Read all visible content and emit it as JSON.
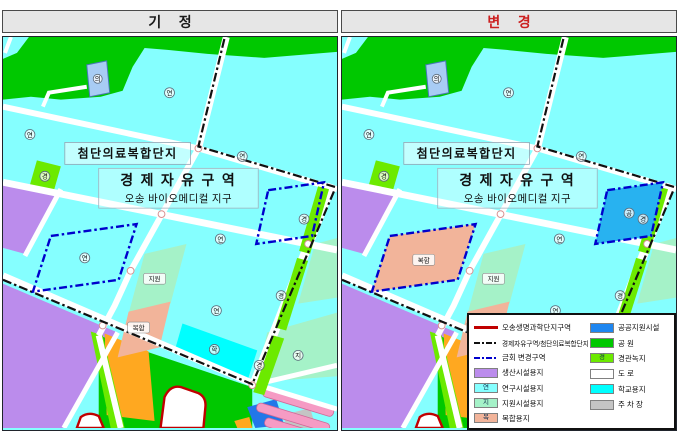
{
  "panels": [
    {
      "id": "before",
      "title": "기 정",
      "title_color": "#1a1a1a",
      "show_legend": false,
      "changes": {
        "zone1_fill": "",
        "zone2_fill": "",
        "zone1_marker": "research_glyph",
        "zone2_marker": ""
      }
    },
    {
      "id": "after",
      "title": "변 경",
      "title_color": "#cc2020",
      "show_legend": true,
      "changes": {
        "zone1_fill": "#f2b49a",
        "zone2_fill": "#28b2f0",
        "zone1_marker": "mixed_pill",
        "zone2_marker": "public_glyph"
      }
    }
  ],
  "map_labels": {
    "complex_zone": "첨단의료복합단지",
    "fez_line1": "경 제 자 유 구 역",
    "fez_line2": "오송 바이오메디컬 지구"
  },
  "glyphs": {
    "research": "연",
    "landscape": "경",
    "school": "학",
    "public": "공",
    "medical": "의",
    "support": "지",
    "support_pill": "지원",
    "mixed_pill": "복합"
  },
  "colors": {
    "research": "#85ffff",
    "park": "#00c800",
    "landscape": "#6cea00",
    "production": "#bb8cec",
    "support": "#a5f2c8",
    "mixed": "#f2b49a",
    "school": "#00ffff",
    "public": "#1e86f0",
    "road": "#ffffff",
    "parking": "#c4c4c4",
    "housing": "#f59bc4",
    "housing_edge": "#d06898",
    "orange": "#ffa820",
    "blue_block": "#2277e8",
    "building": "#a8ccf4",
    "building_edge": "#4878b8",
    "red_line": "#c00000",
    "boundary": "#111111",
    "change": "#0000cc"
  },
  "legend": {
    "left": [
      {
        "label": "오송생명과학단지구역",
        "swatch": "line-solid",
        "color": "#c00000"
      },
      {
        "label": "경제자유구역/첨단의료복합단지",
        "swatch": "line-dashdot",
        "color": "#111111"
      },
      {
        "label": "금회 변경구역",
        "swatch": "line-dashdot",
        "color": "#0000cc"
      },
      {
        "label": "생산시설용지",
        "swatch": "box",
        "color": "#bb8cec"
      },
      {
        "label": "연구시설용지",
        "swatch": "box",
        "color": "#85ffff",
        "glyph": "연"
      },
      {
        "label": "지원시설용지",
        "swatch": "box",
        "color": "#a5f2c8",
        "glyph": "지"
      },
      {
        "label": "복합용지",
        "swatch": "box",
        "color": "#f2b49a",
        "glyph": "복"
      }
    ],
    "right": [
      {
        "label": "공공지원시설",
        "swatch": "box",
        "color": "#1e86f0"
      },
      {
        "label": "공 원",
        "swatch": "box",
        "color": "#00c800"
      },
      {
        "label": "경관녹지",
        "swatch": "box",
        "color": "#6cea00",
        "glyph": "경"
      },
      {
        "label": "도 로",
        "swatch": "box",
        "color": "#ffffff"
      },
      {
        "label": "학교용지",
        "swatch": "box",
        "color": "#00ffff"
      },
      {
        "label": "주 차 장",
        "swatch": "box",
        "color": "#c4c4c4"
      }
    ]
  }
}
